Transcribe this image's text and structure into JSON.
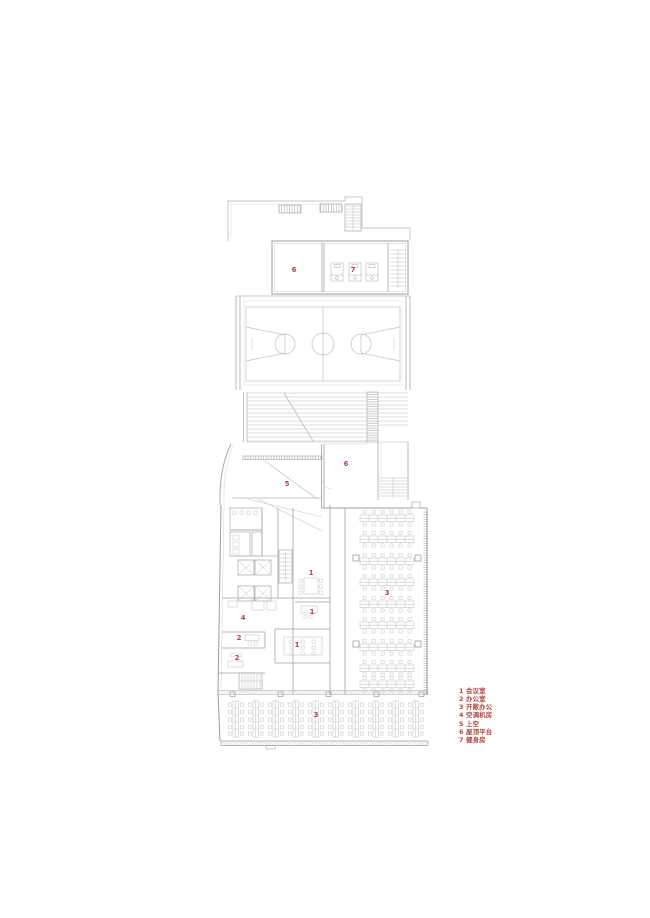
{
  "drawing": {
    "type": "architectural-floor-plan",
    "colors": {
      "accent_red": "#b0473e",
      "line_gray": "#b5b5b5",
      "background": "#ffffff"
    }
  },
  "plan": {
    "markers": [
      {
        "area": "roof-room-left",
        "label": "6"
      },
      {
        "area": "gym",
        "label": "7"
      },
      {
        "area": "void",
        "label": "5"
      },
      {
        "area": "roof-terrace",
        "label": "6"
      },
      {
        "area": "meeting-room-upper",
        "label": "1"
      },
      {
        "area": "office-small",
        "label": "1"
      },
      {
        "area": "ac-plant-room",
        "label": "4"
      },
      {
        "area": "office-a",
        "label": "2"
      },
      {
        "area": "office-b",
        "label": "2"
      },
      {
        "area": "meeting-room-large",
        "label": "1"
      },
      {
        "area": "open-office-right",
        "label": "3"
      },
      {
        "area": "open-office-bottom",
        "label": "3"
      }
    ]
  },
  "legend": {
    "items": [
      {
        "num": "1",
        "label": "会议室"
      },
      {
        "num": "2",
        "label": "办公室"
      },
      {
        "num": "3",
        "label": "开敞办公"
      },
      {
        "num": "4",
        "label": "空调机房"
      },
      {
        "num": "5",
        "label": "上空"
      },
      {
        "num": "6",
        "label": "屋顶平台"
      },
      {
        "num": "7",
        "label": "健身房"
      }
    ]
  }
}
